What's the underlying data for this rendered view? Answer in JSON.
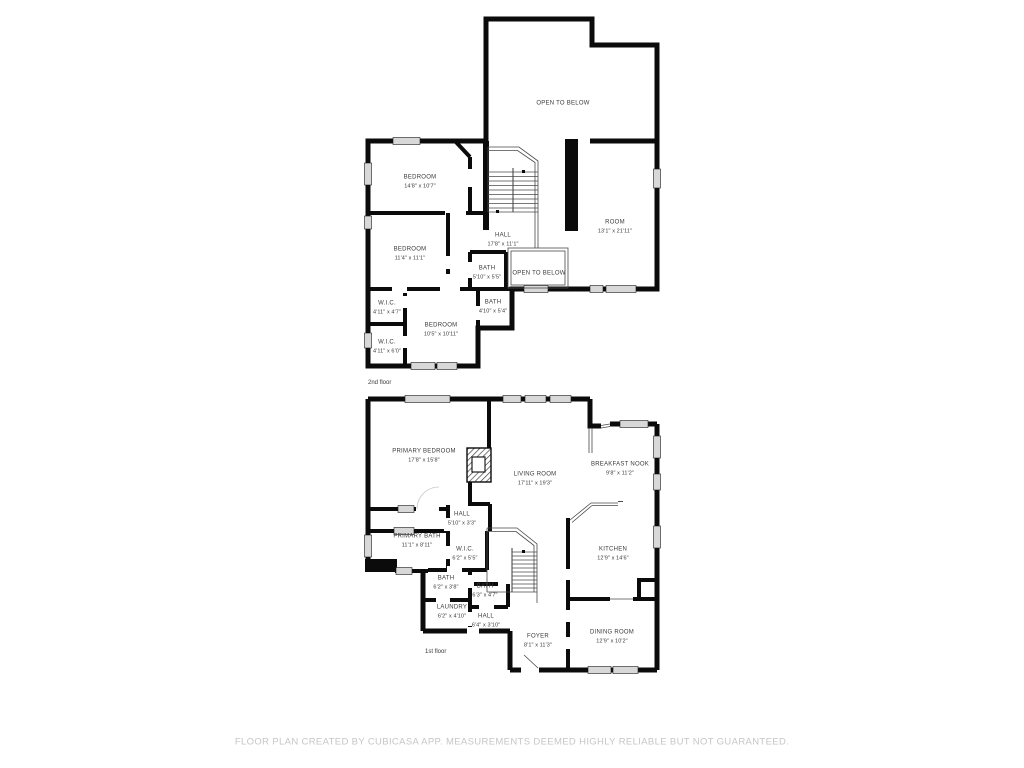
{
  "footer": {
    "disclaimer": "FLOOR PLAN CREATED BY CUBICASA APP. MEASUREMENTS DEEMED HIGHLY RELIABLE BUT NOT GUARANTEED."
  },
  "colors": {
    "wall": "#0b0b0b",
    "window": "#d8d8d8",
    "label": "#3a3a3a",
    "footer": "#c6c6c6"
  },
  "floors": [
    {
      "label": "2nd floor",
      "rooms": [
        {
          "name": "OPEN TO BELOW",
          "dims": ""
        },
        {
          "name": "BEDROOM",
          "dims": "14'8\" x 10'7\""
        },
        {
          "name": "HALL",
          "dims": "17'8\" x 11'1\""
        },
        {
          "name": "ROOM",
          "dims": "13'1\" x 21'11\""
        },
        {
          "name": "BEDROOM",
          "dims": "11'4\" x 11'1\""
        },
        {
          "name": "BATH",
          "dims": "5'10\" x 5'5\""
        },
        {
          "name": "OPEN TO BELOW",
          "dims": ""
        },
        {
          "name": "BATH",
          "dims": "4'10\" x 5'4\""
        },
        {
          "name": "W.I.C.",
          "dims": "4'11\" x 4'7\""
        },
        {
          "name": "BEDROOM",
          "dims": "10'5\" x 10'11\""
        },
        {
          "name": "W.I.C.",
          "dims": "4'11\" x 6'0\""
        }
      ]
    },
    {
      "label": "1st floor",
      "rooms": [
        {
          "name": "PRIMARY BEDROOM",
          "dims": "17'8\" x 15'8\""
        },
        {
          "name": "LIVING ROOM",
          "dims": "17'11\" x 19'3\""
        },
        {
          "name": "BREAKFAST NOOK",
          "dims": "9'8\" x 11'2\""
        },
        {
          "name": "HALL",
          "dims": "5'10\" x 3'3\""
        },
        {
          "name": "PRIMARY BATH",
          "dims": "11'1\" x 8'11\""
        },
        {
          "name": "W.I.C.",
          "dims": "6'2\" x 5'5\""
        },
        {
          "name": "KITCHEN",
          "dims": "12'9\" x 14'6\""
        },
        {
          "name": "BATH",
          "dims": "6'2\" x 3'8\""
        },
        {
          "name": "BATH",
          "dims": "6'3\" x 4'7\""
        },
        {
          "name": "LAUNDRY",
          "dims": "6'2\" x 4'10\""
        },
        {
          "name": "HALL",
          "dims": "6'4\" x 3'10\""
        },
        {
          "name": "FOYER",
          "dims": "8'1\" x 11'3\""
        },
        {
          "name": "DINING ROOM",
          "dims": "12'9\" x 10'2\""
        }
      ]
    }
  ]
}
